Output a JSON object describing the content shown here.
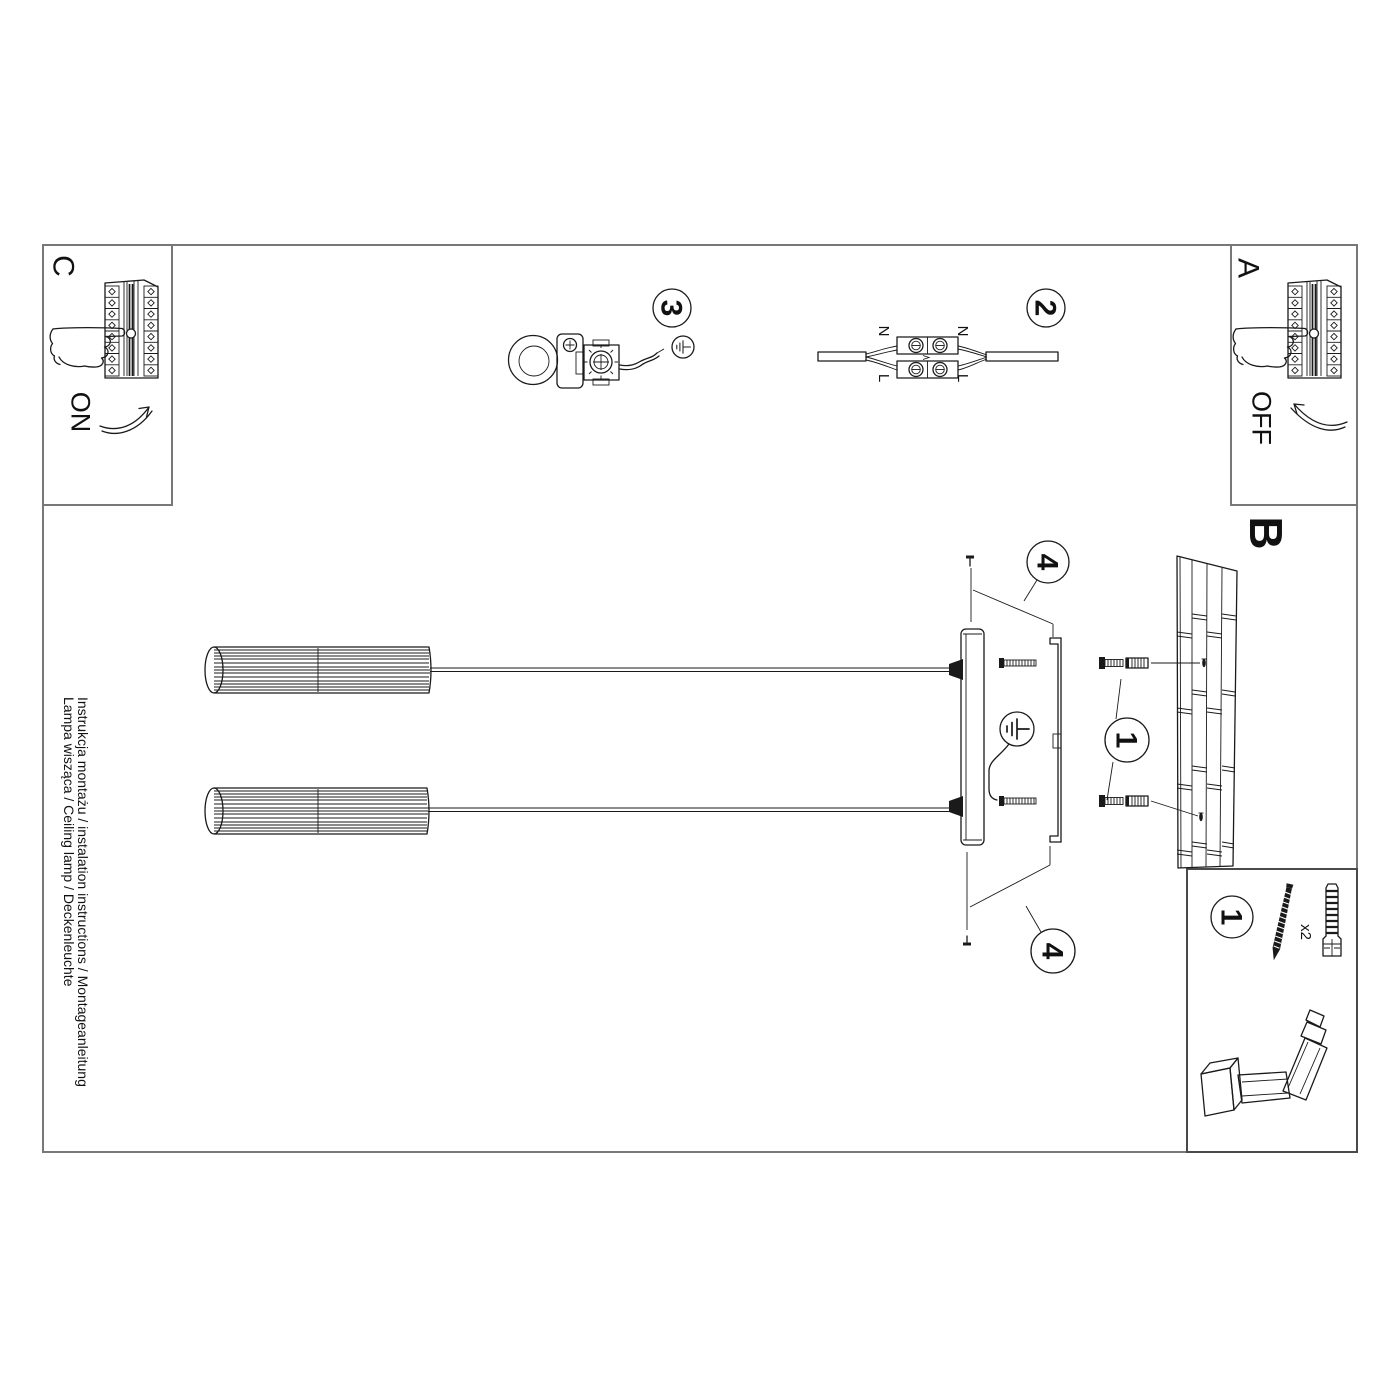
{
  "title": {
    "line1": "Instrukcja montażu / instalation instructions / Montageanleitung",
    "line2": "Lampa wisząca / Ceiling lamp / Deckenleuchte"
  },
  "sections": {
    "a": {
      "label": "A",
      "action": "OFF"
    },
    "b": {
      "label": "B"
    },
    "c": {
      "label": "C",
      "action": "ON"
    }
  },
  "steps": {
    "s1": "1",
    "s2": "2",
    "s3": "3",
    "s4": "4"
  },
  "wiring": {
    "left_top": "N",
    "left_bottom": "L",
    "right_top": "N",
    "right_bottom": "L"
  },
  "parts": {
    "step": "1",
    "screw_qty": "x2"
  },
  "icons": {
    "ground": "earth-ground-symbol",
    "hand": "pointing-hand",
    "arrow_on": "rotate-arrow-clockwise",
    "arrow_off": "rotate-arrow-counterclockwise",
    "drill": "power-drill",
    "screw": "mounting-screw",
    "wall_plug": "expansion-wall-plug"
  },
  "colors": {
    "line": "#1a1a1a",
    "frame": "#787878",
    "background": "#ffffff"
  }
}
